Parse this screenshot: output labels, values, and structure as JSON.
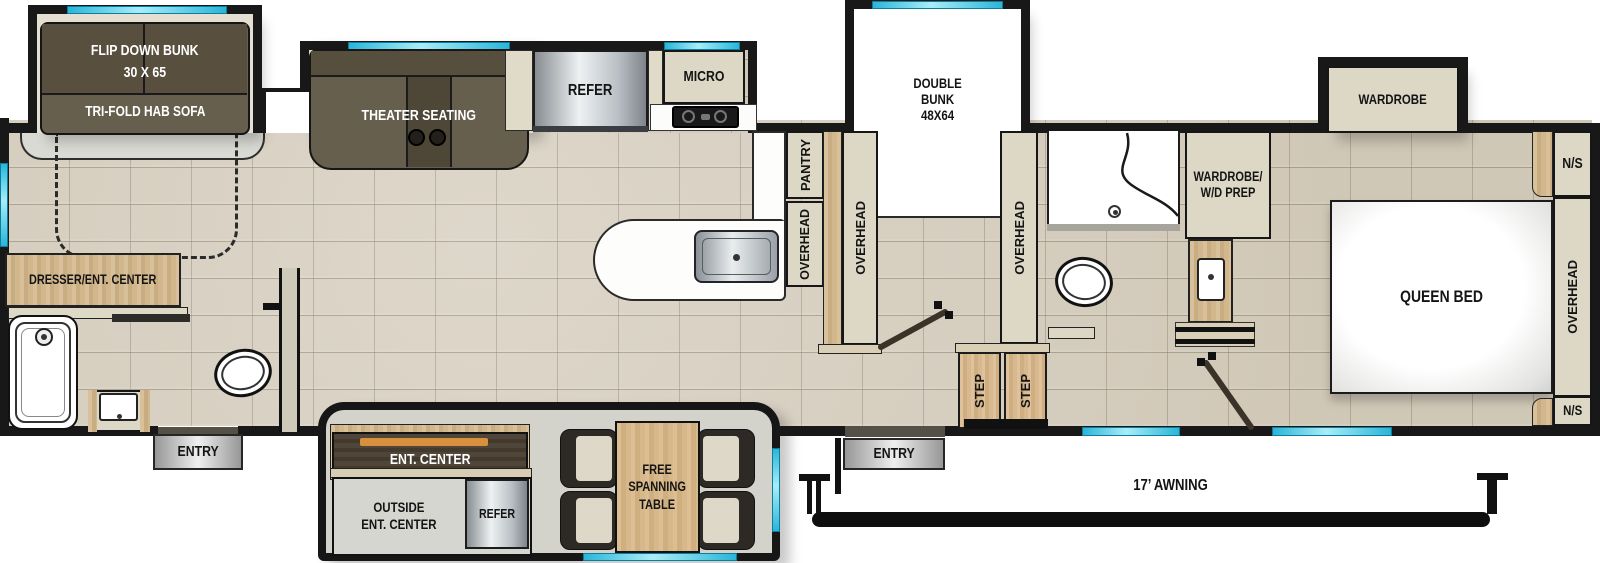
{
  "floorplan": {
    "labels": {
      "flip_down_bunk": "FLIP DOWN BUNK",
      "flip_down_bunk_size": "30 X 65",
      "tri_fold_sofa": "TRI-FOLD HAB SOFA",
      "theater_seating": "THEATER SEATING",
      "refer": "REFER",
      "micro": "MICRO",
      "double_bunk_l1": "DOUBLE",
      "double_bunk_l2": "BUNK",
      "double_bunk_l3": "48X64",
      "pantry": "PANTRY",
      "overhead": "OVERHEAD",
      "wardrobe": "WARDROBE",
      "wardrobe_wd_l1": "WARDROBE/",
      "wardrobe_wd_l2": "W/D PREP",
      "nightstand": "N/S",
      "queen_bed": "QUEEN BED",
      "dresser_ent_center": "DRESSER/ENT. CENTER",
      "entry": "ENTRY",
      "ent_center": "ENT. CENTER",
      "outside_ent_l1": "OUTSIDE",
      "outside_ent_l2": "ENT. CENTER",
      "free_table_l1": "FREE",
      "free_table_l2": "SPANNING",
      "free_table_l3": "TABLE",
      "step": "STEP",
      "awning": "17’ AWNING"
    },
    "colors": {
      "wall": "#181818",
      "window": "#2ab5d8",
      "cabinet": "#ddd7c6",
      "wood": "#cfb188",
      "floor": "#d7cfc0",
      "sofa": "#675f4d",
      "accent": "#d8903e"
    }
  }
}
